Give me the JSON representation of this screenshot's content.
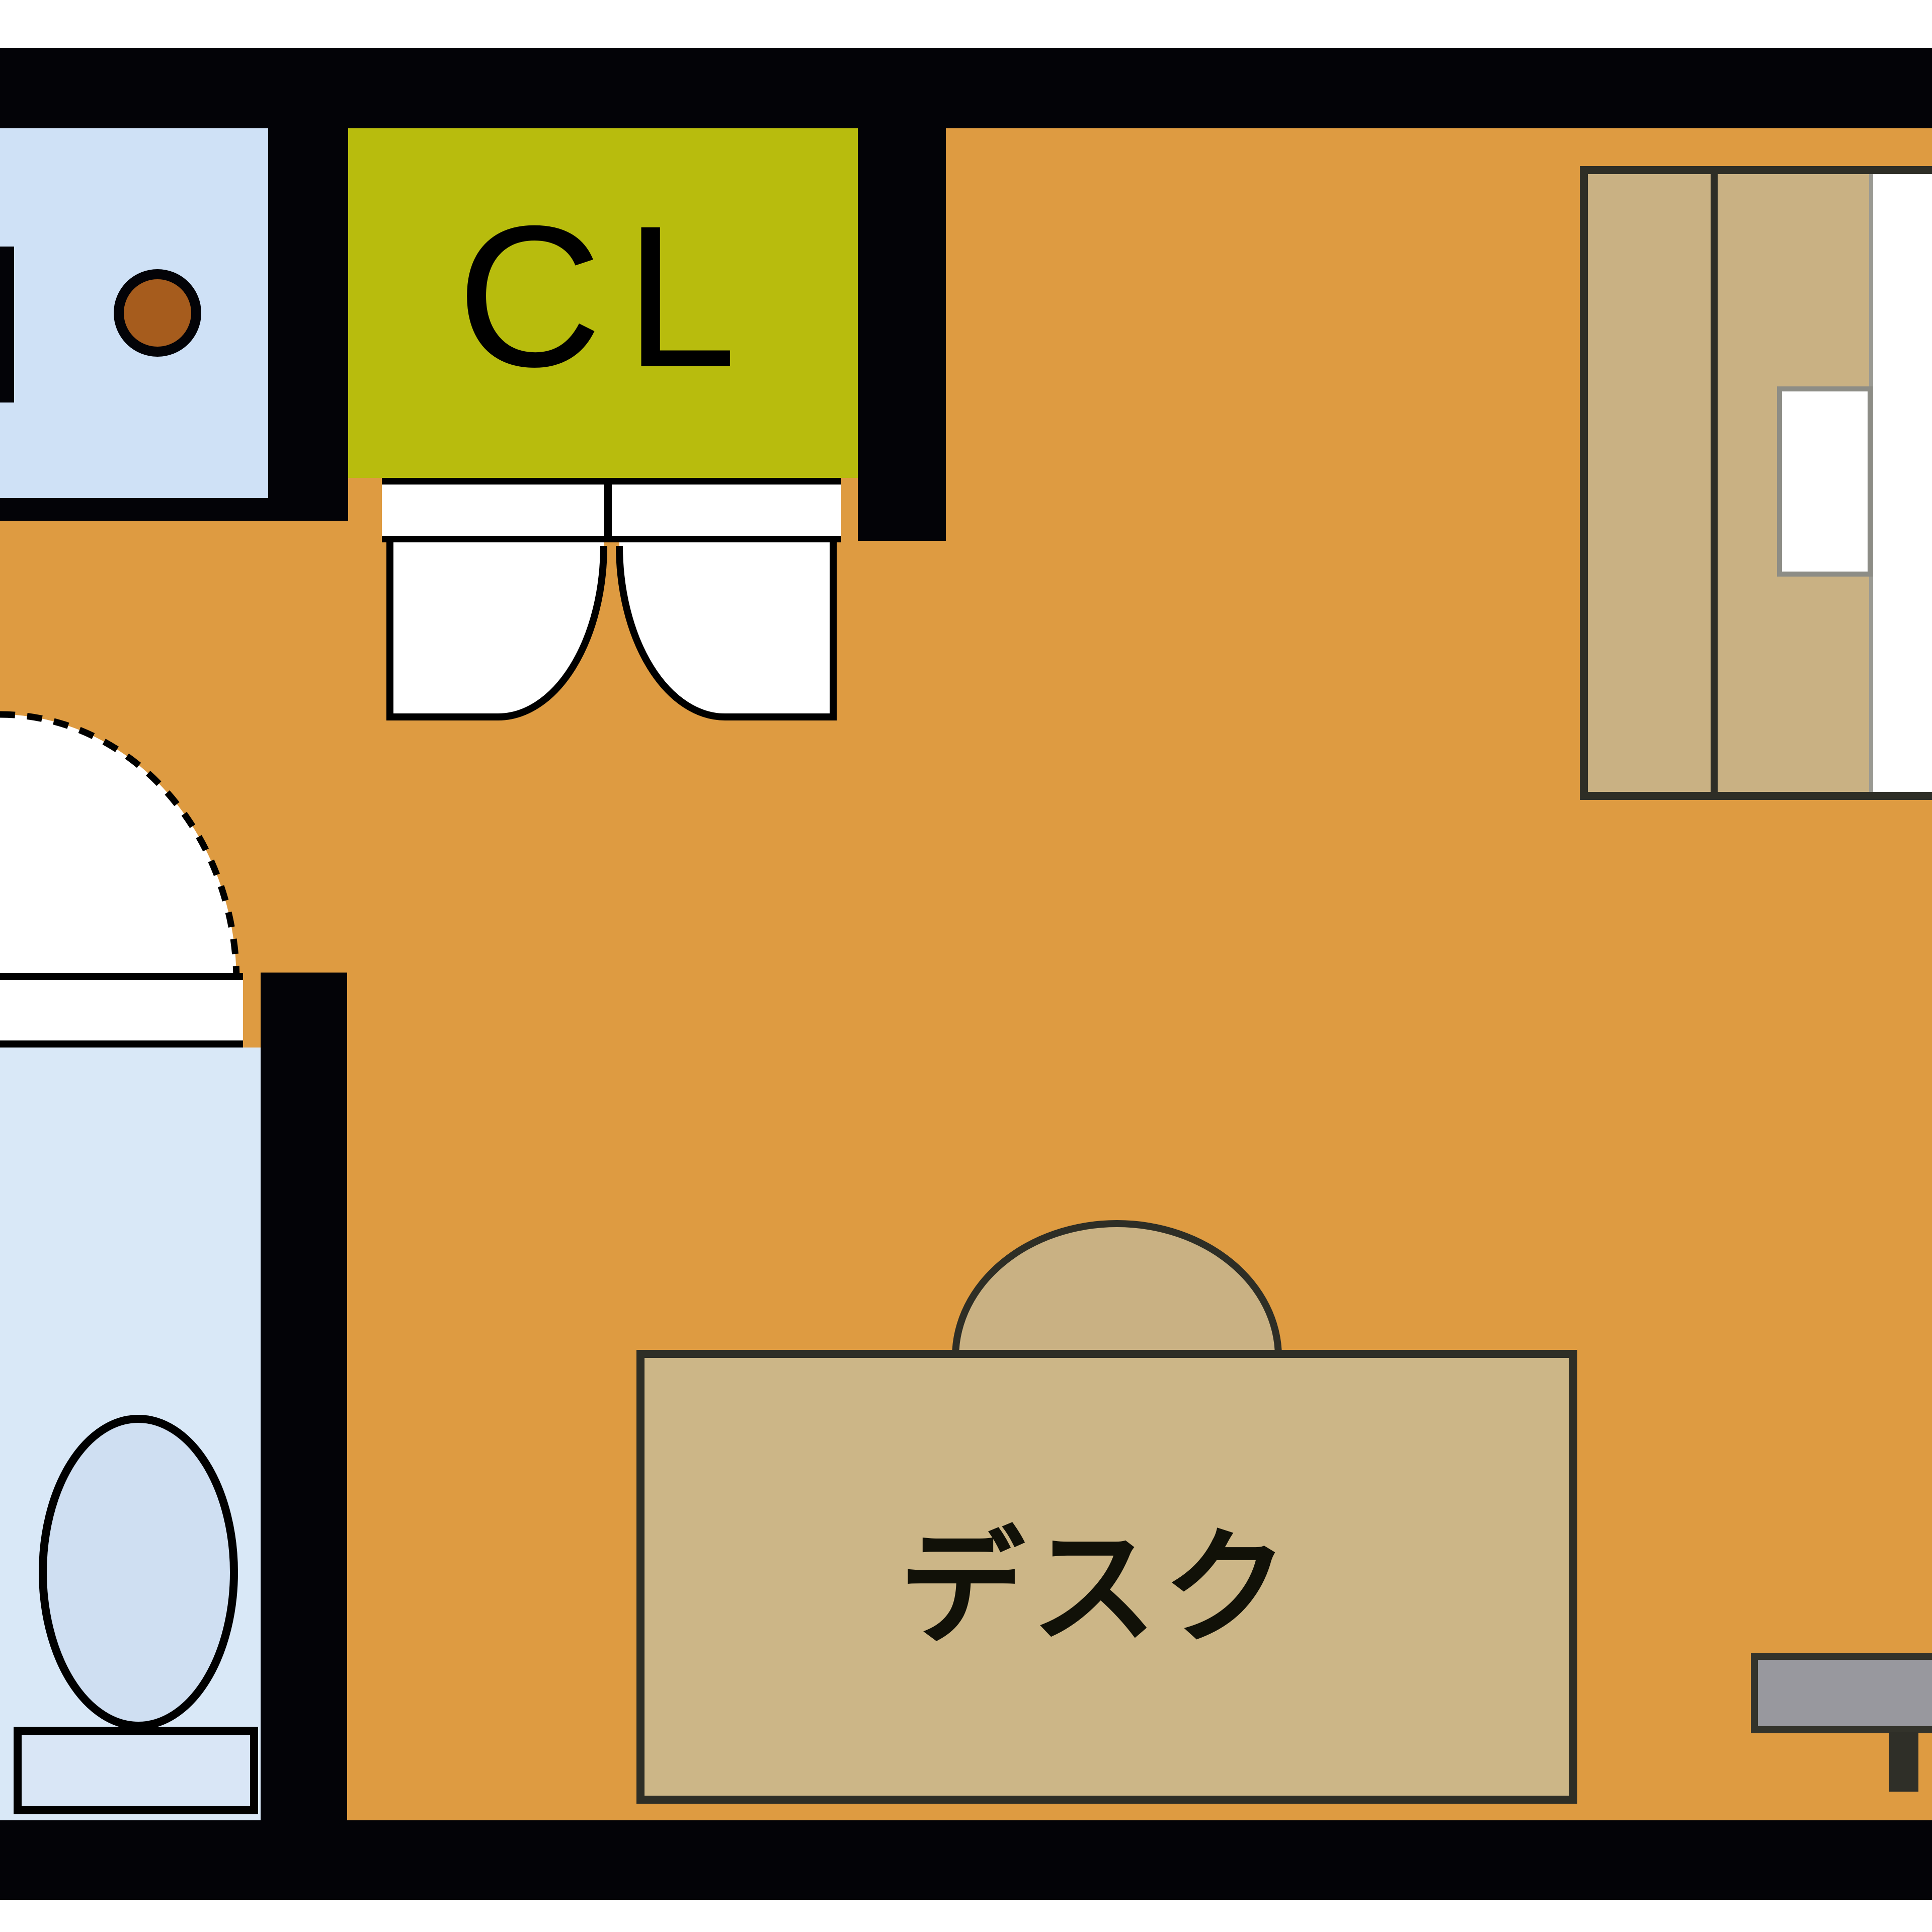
{
  "title": "studio apartment floor plan",
  "closet": {
    "label": "CL"
  },
  "desk": {
    "label": "デスク"
  },
  "colors": {
    "floor": "#de9b41",
    "wall": "#030307",
    "closet": "#b8bc0d",
    "kitchen": "#cfe1f6",
    "bathroom": "#d9e8f7",
    "toilet": "#cfdff2",
    "tank": "#d9e6f6",
    "furniture": "#c9b183",
    "desk": "#ccb687",
    "outline": "#2e2e26",
    "board": "#98989e",
    "burner": "#a65c1d",
    "pillow": "#ffffff"
  }
}
